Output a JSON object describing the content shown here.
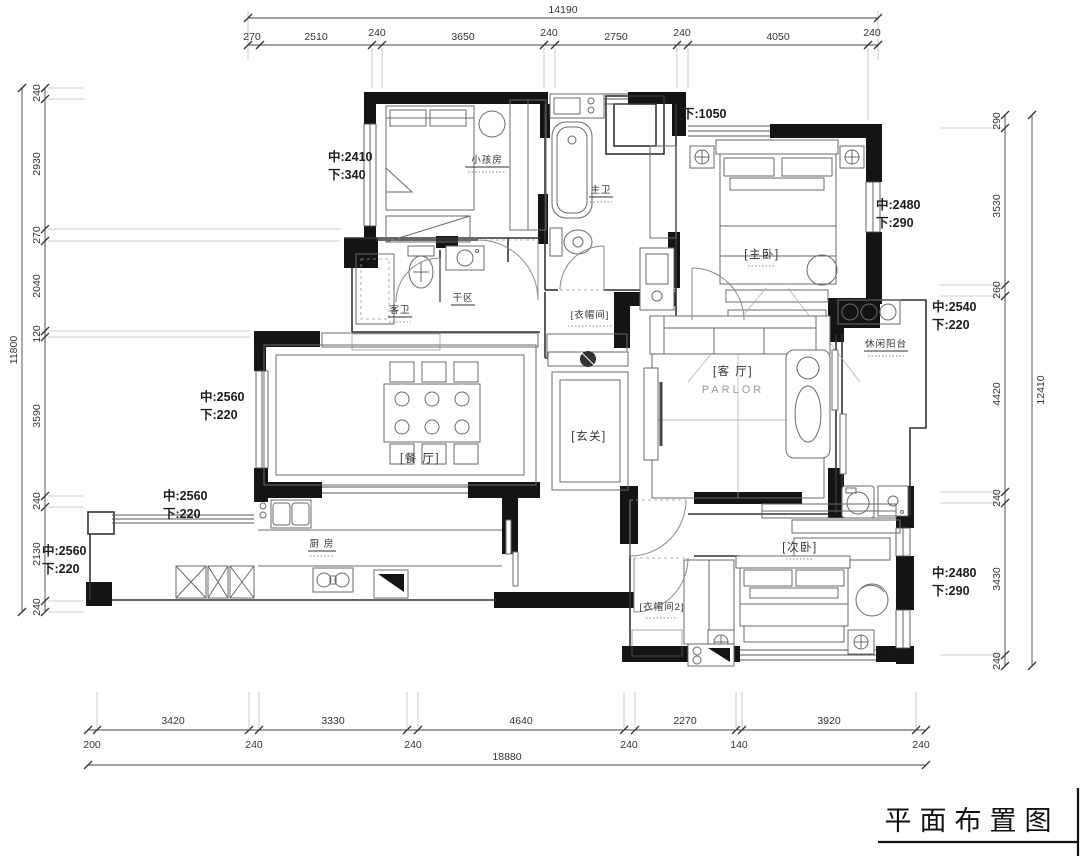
{
  "title": {
    "text": "平面布置图"
  },
  "dims": {
    "top": {
      "total": "14190",
      "segs": [
        "270",
        "2510",
        "240",
        "3650",
        "240",
        "2750",
        "240",
        "4050",
        "240"
      ]
    },
    "left": {
      "total": "11800",
      "segs": [
        "240",
        "2930",
        "270",
        "2040",
        "120",
        "3590",
        "240",
        "2130",
        "240"
      ]
    },
    "right": {
      "total": "12410",
      "segs": [
        "290",
        "3530",
        "260",
        "4420",
        "240",
        "3430",
        "240"
      ]
    },
    "bottom": {
      "total": "18880",
      "segs": [
        "3420",
        "3330",
        "4640",
        "2270",
        "3920"
      ],
      "small": [
        "200",
        "240",
        "240",
        "240",
        "140",
        "240"
      ]
    }
  },
  "rooms": {
    "kids": "小孩房",
    "master_bath": "主卫",
    "master": "[主卧]",
    "guest_bath": "客卫",
    "dry": "干区",
    "cloak": "[衣帽间]",
    "foyer": "[玄关]",
    "dining": "[餐 厅]",
    "parlor": "[客 厅]",
    "parlor_en": "PARLOR",
    "balcony": "休闲阳台",
    "kitchen": "厨 房",
    "second": "[次卧]",
    "cloak2": "[衣帽间2]"
  },
  "ann": {
    "a1": {
      "l1": "中:2410",
      "l2": "下:340"
    },
    "a2": {
      "l1": "下:1050"
    },
    "a3": {
      "l1": "中:2480",
      "l2": "下:290"
    },
    "a4": {
      "l1": "中:2540",
      "l2": "下:220"
    },
    "a5": {
      "l1": "中:2560",
      "l2": "下:220"
    },
    "a6": {
      "l1": "中:2560",
      "l2": "下:220"
    },
    "a7": {
      "l1": "中:2560",
      "l2": "下:220"
    },
    "a8": {
      "l1": "中:2480",
      "l2": "下:290"
    }
  },
  "colors": {
    "wall": "#141414",
    "line": "#555555",
    "background": "#ffffff"
  }
}
